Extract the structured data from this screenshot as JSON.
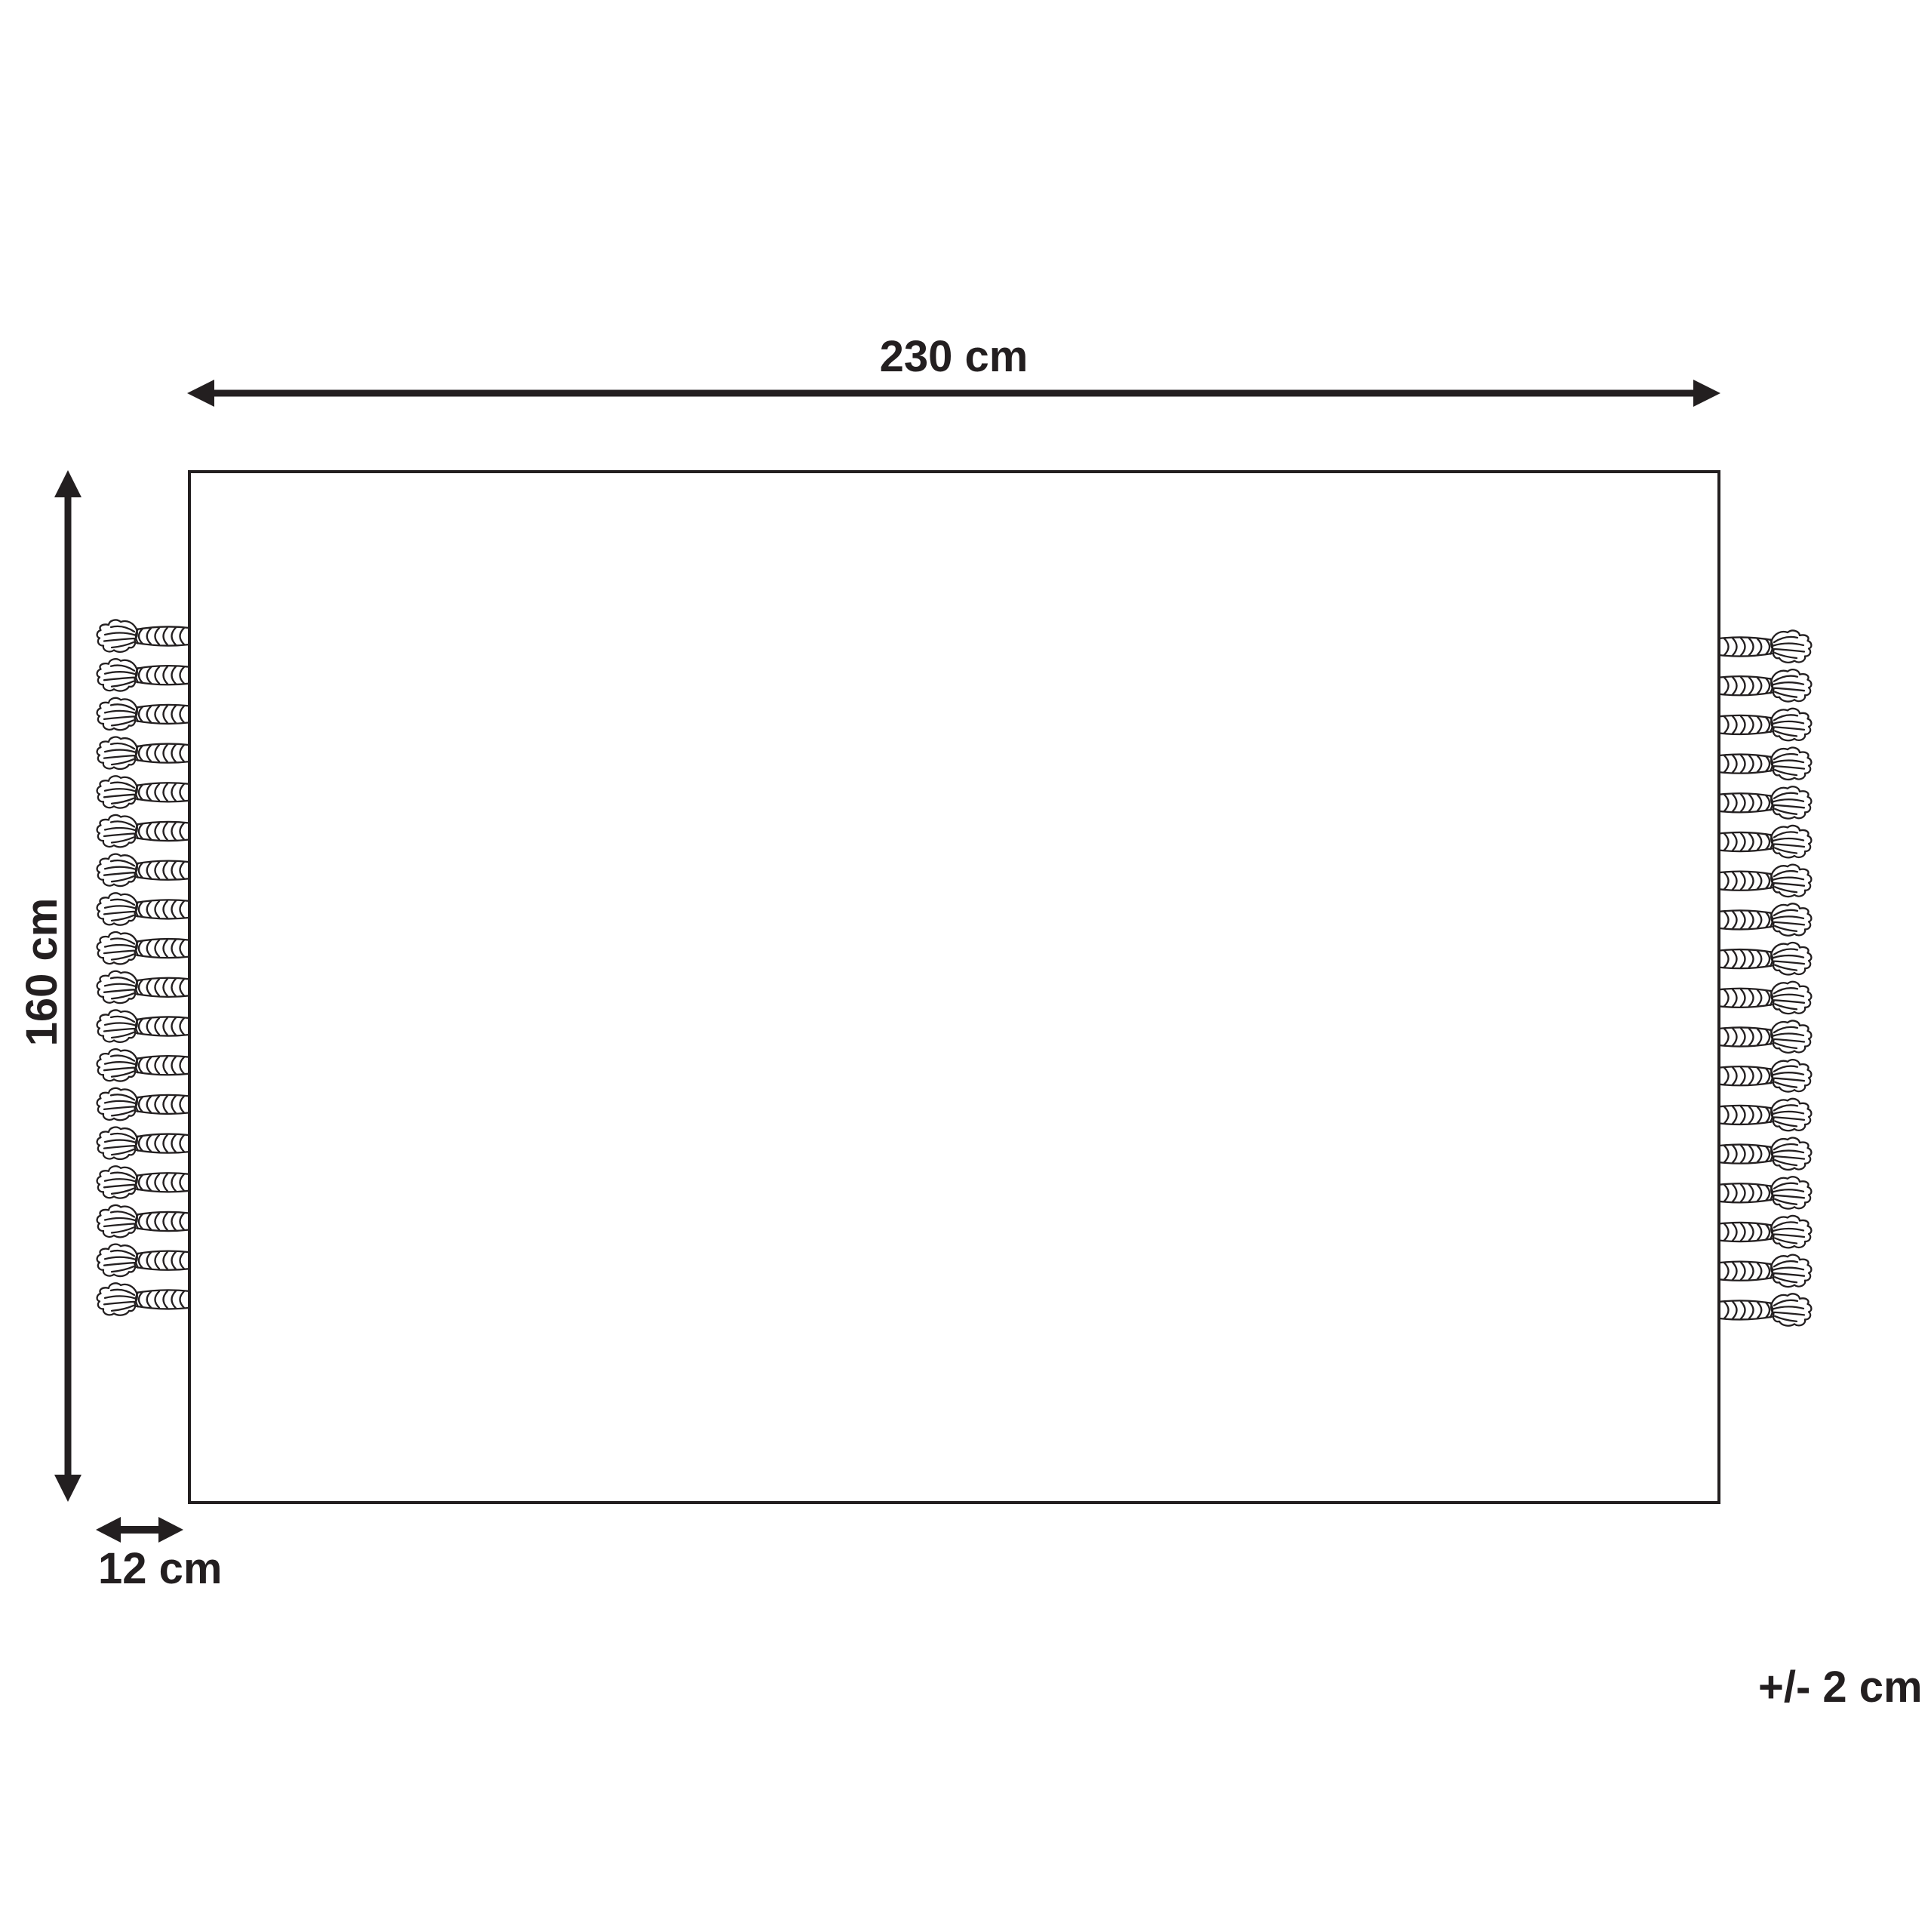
{
  "diagram": {
    "width": {
      "label": "230 cm"
    },
    "height": {
      "label": "160 cm"
    },
    "fringe": {
      "label": "12 cm"
    },
    "tolerance": {
      "label": "+/- 2 cm"
    },
    "tassels_per_side": 18,
    "colors": {
      "line": "#231f20",
      "background": "#ffffff"
    }
  }
}
